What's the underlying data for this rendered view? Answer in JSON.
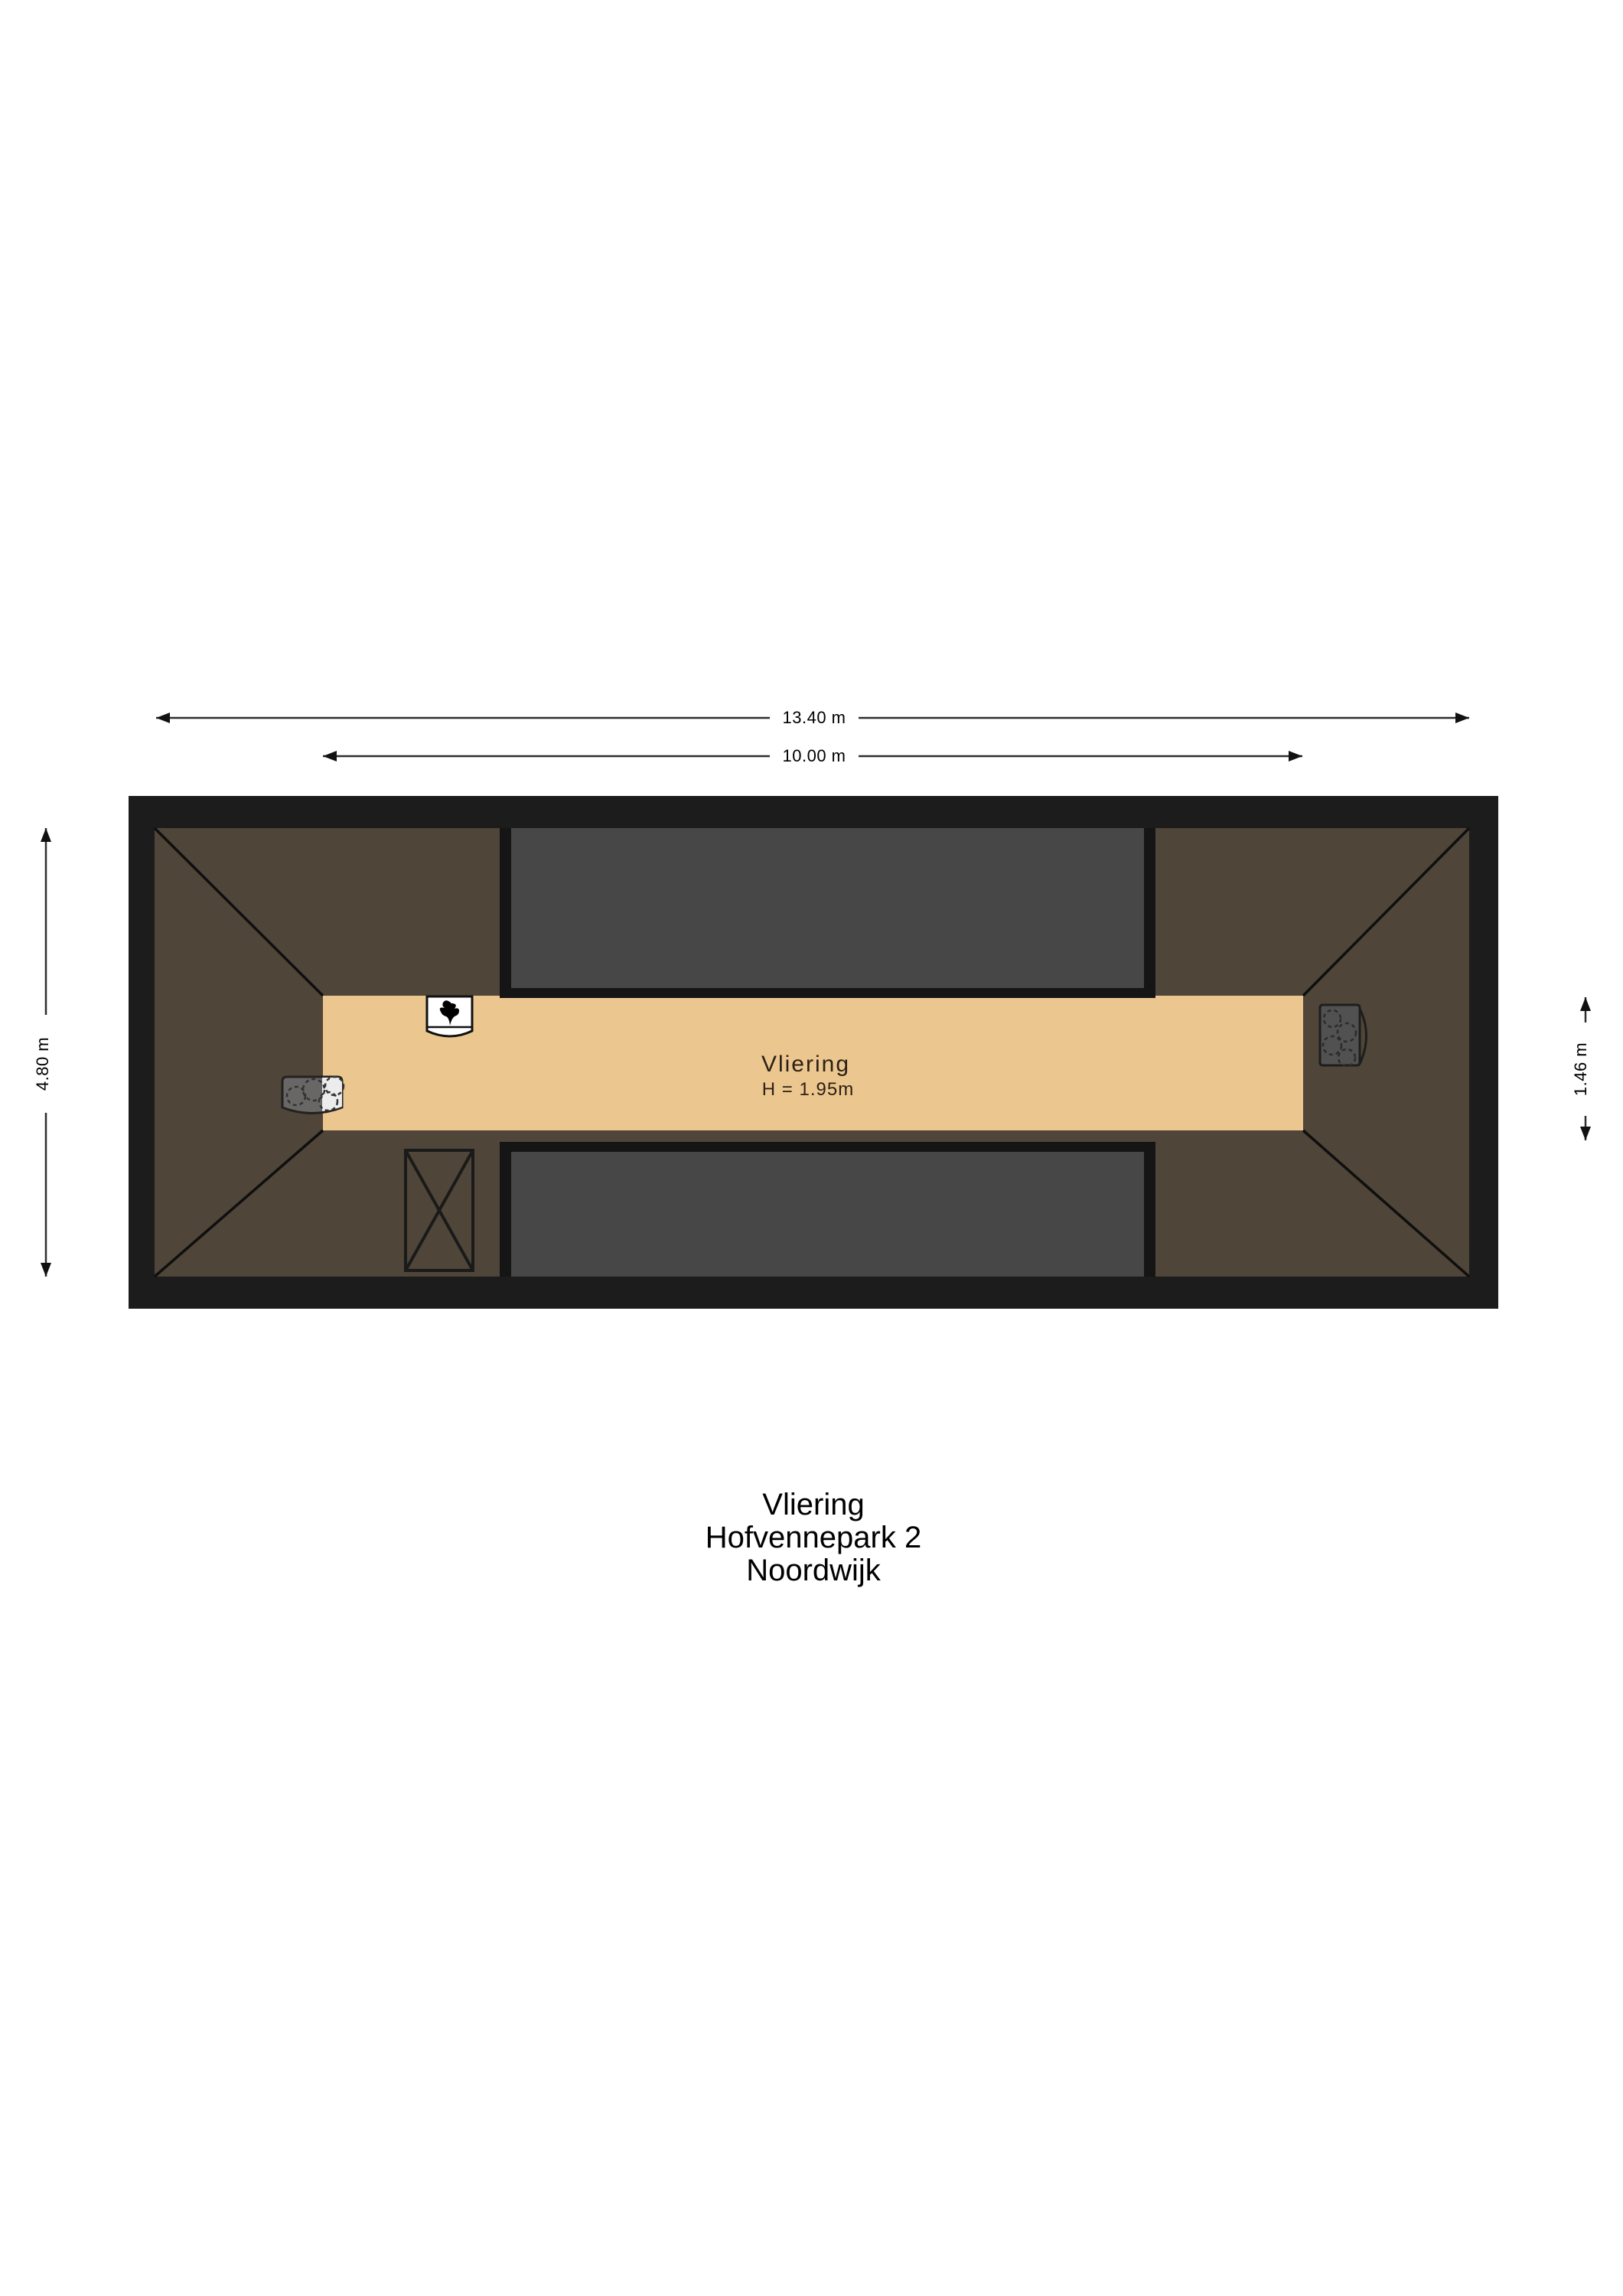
{
  "document": {
    "floor_name": "Vliering",
    "address_line": "Hofvennepark 2",
    "city": "Noordwijk"
  },
  "room_label": {
    "name": "Vliering",
    "ceiling_height": "H = 1.95m"
  },
  "dimensions": {
    "overall_width": "13.40 m",
    "floor_width": "10.00 m",
    "overall_depth": "4.80 m",
    "floor_depth": "1.46 m"
  },
  "colors": {
    "wall_black": "#1c1c1c",
    "roof_brown": "#4f4538",
    "floor_beige": "#ecc68f",
    "roof_window_gray": "#474747",
    "window_border": "#151515",
    "background": "#ffffff",
    "dimension_line": "#2e2e2e"
  },
  "icons": {
    "ventilation_unit": "mechanical-ventilation-unit",
    "boiler_unit_left": "boiler-unit",
    "boiler_unit_right": "boiler-unit",
    "void_opening": "void-cross"
  }
}
